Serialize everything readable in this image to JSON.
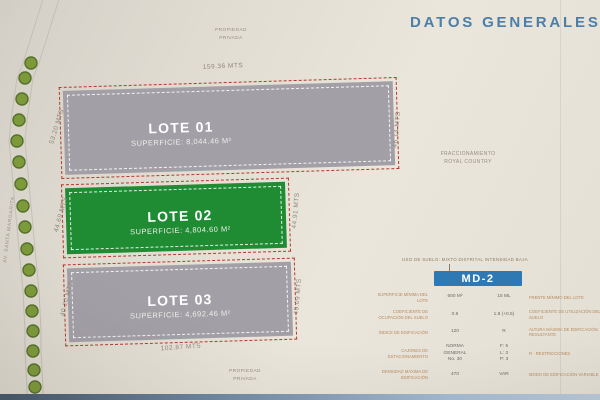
{
  "title": "DATOS GENERALES",
  "plan": {
    "road_label": "AV. SANTA MARGARITA",
    "notes": {
      "top_line1": "PROPIEDAD",
      "top_line2": "PRIVADA",
      "bottom_line1": "PROPIEDAD",
      "bottom_line2": "PRIVADA",
      "fracc_line1": "FRACCIONAMIENTO",
      "fracc_line2": "ROYAL COUNTRY"
    },
    "lots": [
      {
        "name": "LOTE 01",
        "superficie": "SUPERFICIE: 8,044.46 M²"
      },
      {
        "name": "LOTE 02",
        "superficie": "SUPERFICIE: 4,804.60 M²"
      },
      {
        "name": "LOTE 03",
        "superficie": "SUPERFICIE: 4,692.46 M²"
      }
    ],
    "measurements": {
      "top": "159.36 MTS",
      "bottom": "102.87 MTS",
      "left1": "53.20 MTS",
      "left2": "44.69 MTS",
      "left3": "40.20 MTS",
      "right1": "46.14 MTS",
      "right2": "44.91 MTS",
      "right3": "45.09 MTS"
    }
  },
  "zoning": {
    "uso_de_suelo": "USO DE SUELO: MIXTO DISTRITAL INTENSIDAD BAJA",
    "clave": "MD-2",
    "rows": [
      {
        "label_left": "SUPERFICIE MÍNIMA DEL LOTE",
        "value_left": "600 M²",
        "value_right": "15 ML",
        "label_right": "FRENTE MÍNIMO DEL LOTE"
      },
      {
        "label_left": "COEFICIENTE DE OCUPACIÓN DEL SUELO",
        "value_left": "0.6",
        "value_right": "1.8 (+0.5)",
        "label_right": "COEFICIENTE DE UTILIZACIÓN DEL SUELO"
      },
      {
        "label_left": "ÍNDICE DE EDIFICACIÓN",
        "value_left": "120",
        "value_right": "R",
        "label_right": "ALTURA MÁXIMA DE EDIFICACIÓN: RESULTANTE"
      },
      {
        "label_left": "CAJONES DE ESTACIONAMIENTO",
        "value_left": "NORMA\nGENERAL\nNo. 30",
        "value_right": "F: 5\nL: 3\nP: 3",
        "label_right": "R · RESTRICCIONES"
      },
      {
        "label_left": "DENSIDAD MÁXIMA DE EDIFICACIÓN",
        "value_left": "470",
        "value_right": "VAR",
        "label_right": "MODO DE EDIFICACIÓN VARIABLE"
      }
    ]
  },
  "colors": {
    "accent_blue": "#2e78b4",
    "title_blue": "#4d7ea8",
    "lot_gray": "#a39fa7",
    "lot_green": "#1f8c33",
    "boundary_red": "#b23a2c"
  }
}
